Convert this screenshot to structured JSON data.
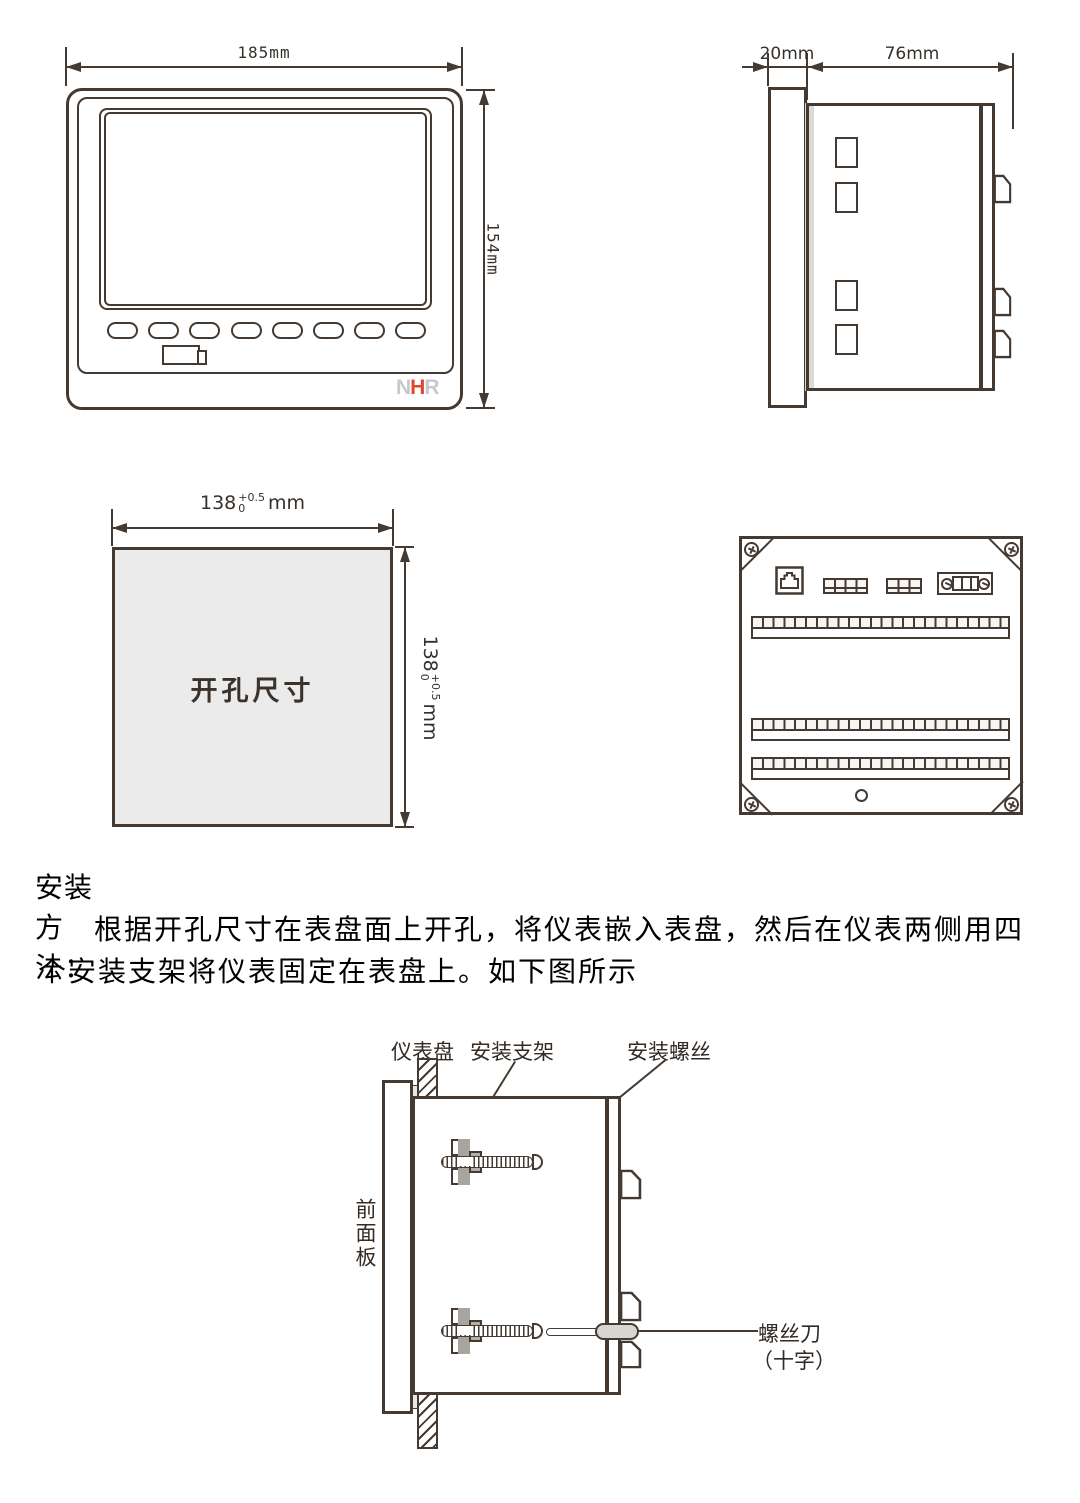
{
  "front_view": {
    "width_label": "185mm",
    "height_label": "154mm",
    "logo": [
      "N",
      "H",
      "R"
    ],
    "key_count": 8
  },
  "side_view": {
    "front_depth_label": "20mm",
    "body_depth_label": "76mm"
  },
  "cutout": {
    "title": "开孔尺寸",
    "width": {
      "value": "138",
      "tol_plus": "+0.5",
      "tol_minus": "0",
      "unit": "mm"
    },
    "height": {
      "value": "138",
      "tol_plus": "+0.5",
      "tol_minus": "0",
      "unit": "mm"
    }
  },
  "install": {
    "heading": "安装方法：",
    "para_line1": "根据开孔尺寸在表盘面上开孔，将仪表嵌入表盘，然后在仪表两侧用四",
    "para_line2": "个安装支架将仪表固定在表盘上。如下图所示"
  },
  "mount_diagram": {
    "panel_label": "仪表盘",
    "bracket_label": "安装支架",
    "screw_label": "安装螺丝",
    "front_panel_label": "前面板",
    "screwdriver_label": "螺丝刀",
    "screwdriver_type_label": "（十字）"
  },
  "colors": {
    "line": "#453a31",
    "cutout_fill": "#ebebeb",
    "logo_gray": "#c4c9cf",
    "logo_red": "#e2452c"
  }
}
